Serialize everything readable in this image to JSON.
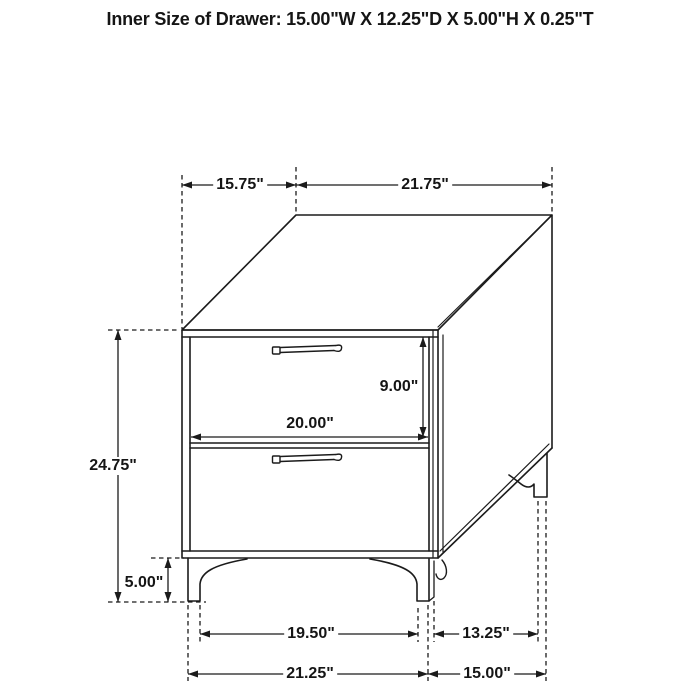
{
  "title": "Inner Size of Drawer: 15.00\"W X 12.25\"D X 5.00\"H X 0.25\"T",
  "labels": {
    "top_depth": "15.75\"",
    "top_width": "21.75\"",
    "overall_height": "24.75\"",
    "leg_height": "5.00\"",
    "drawer_front_height": "9.00\"",
    "drawer_front_width": "20.00\"",
    "front_feet_inner_width": "19.50\"",
    "side_feet_inner_depth": "13.25\"",
    "front_feet_outer_width": "21.25\"",
    "side_feet_outer_depth": "15.00\""
  }
}
